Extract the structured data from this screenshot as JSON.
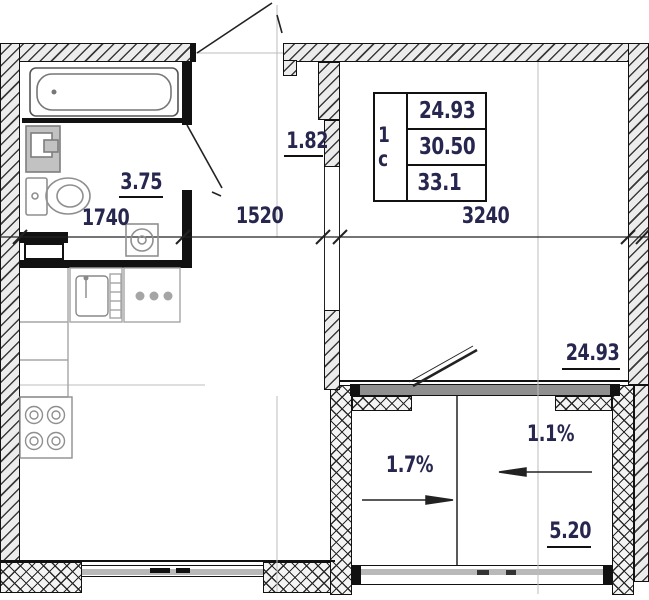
{
  "title": "Studio apartment floor plan",
  "info_table": {
    "unit_type": "1 с",
    "area_rows": [
      "24.93",
      "30.50",
      "33.1"
    ]
  },
  "rooms": {
    "bathroom_area": "3.75",
    "hall_area": "1.82",
    "living_room_area": "24.93",
    "balcony_area": "5.20"
  },
  "dimensions_mm": {
    "bathroom_width": "1740",
    "hall_width": "1520",
    "living_room_width": "3240"
  },
  "slopes": {
    "balcony_left": "1.7%",
    "balcony_right": "1.1%"
  },
  "colors": {
    "label_text": "#26264f",
    "wall_fill": "#ececec",
    "line": "#111111",
    "fixture_gray": "#8f8f8f",
    "glazing_gray": "#9a9a9a"
  }
}
